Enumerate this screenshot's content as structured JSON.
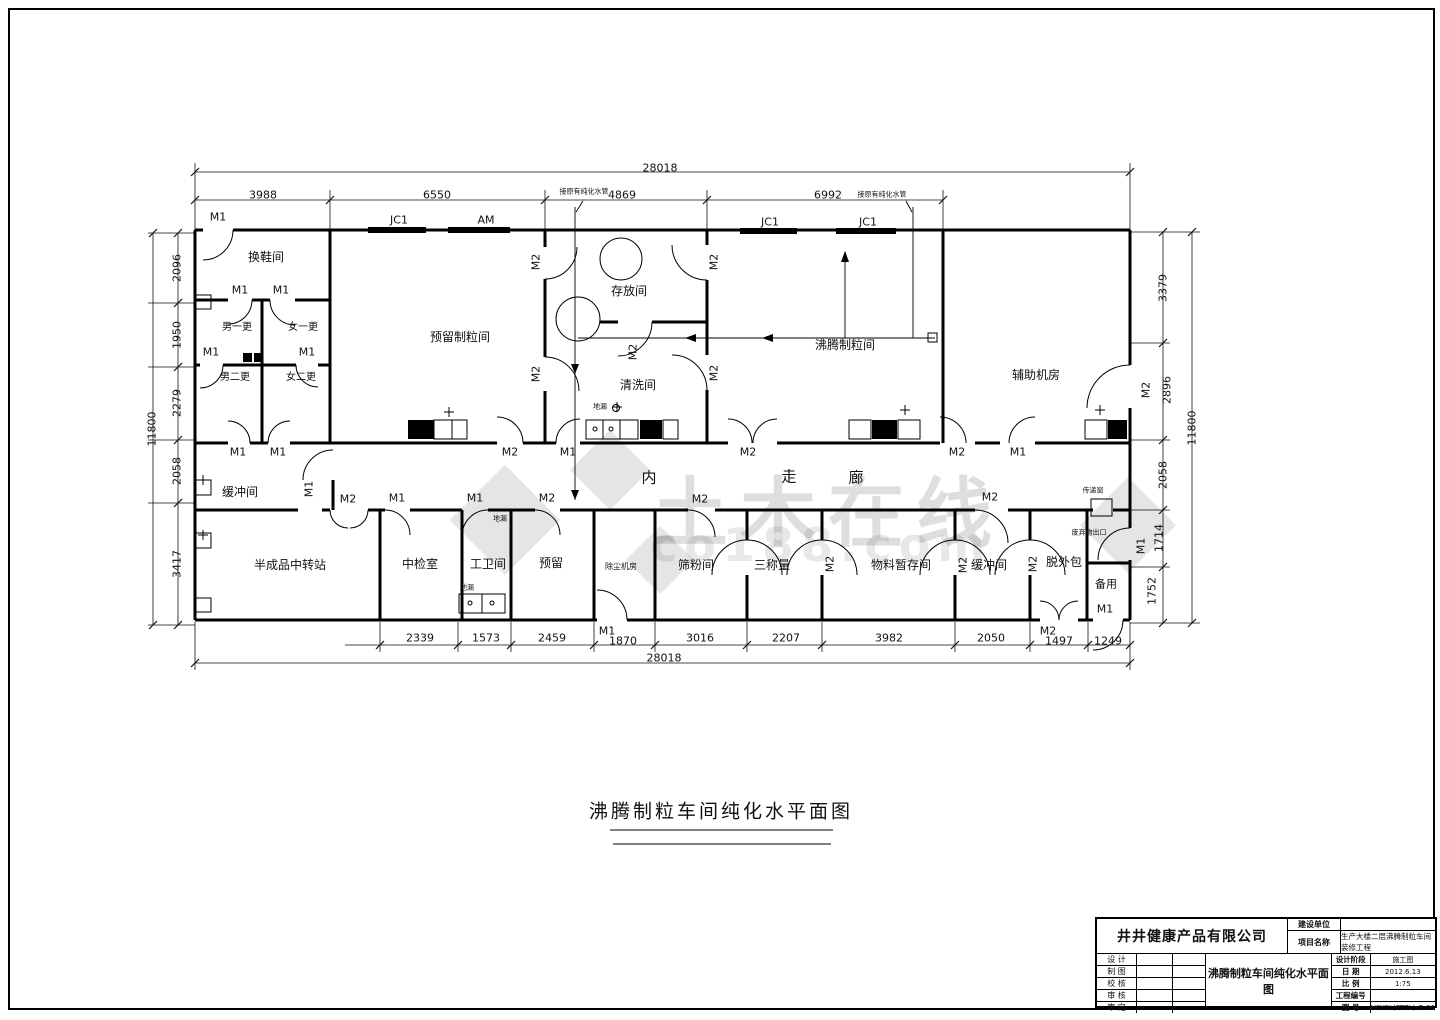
{
  "watermark": {
    "text": "土木在线",
    "sub": "co188.com"
  },
  "title_block": {
    "company": "井井健康产品有限公司",
    "owner_label": "建设单位",
    "owner_value": "",
    "project_label": "项目名称",
    "project_value": "生产大楼二层沸腾制粒车间装修工程",
    "sign_rows": [
      "设 计",
      "制 图",
      "校 核",
      "审 核",
      "审 定"
    ],
    "drawing_title": "沸腾制粒车间纯化水平面图",
    "fields": [
      {
        "label": "设计阶段",
        "value": "施工图"
      },
      {
        "label": "日  期",
        "value": "2012.6.13"
      },
      {
        "label": "比  例",
        "value": "1:75"
      },
      {
        "label": "工程编号",
        "value": ""
      },
      {
        "label": "图  号",
        "value": "HSYSL(FTZL)-G-06"
      }
    ]
  },
  "plan_labels": [
    {
      "t": "28018",
      "x": 660,
      "y": 168,
      "n": "dim-total-top"
    },
    {
      "t": "3988",
      "x": 263,
      "y": 195,
      "n": "dim-label"
    },
    {
      "t": "6550",
      "x": 437,
      "y": 195,
      "n": "dim-label"
    },
    {
      "t": "4869",
      "x": 622,
      "y": 195,
      "n": "dim-label"
    },
    {
      "t": "6992",
      "x": 828,
      "y": 195,
      "n": "dim-label"
    },
    {
      "t": "接原有纯化水管",
      "x": 584,
      "y": 192,
      "s": 7,
      "n": "pipe-annotation"
    },
    {
      "t": "接原有纯化水管",
      "x": 882,
      "y": 195,
      "s": 7,
      "n": "pipe-annotation"
    },
    {
      "t": "M1",
      "x": 218,
      "y": 217,
      "n": "door-label"
    },
    {
      "t": "JC1",
      "x": 399,
      "y": 220,
      "n": "window-label"
    },
    {
      "t": "AM",
      "x": 486,
      "y": 220,
      "n": "window-label"
    },
    {
      "t": "JC1",
      "x": 770,
      "y": 222,
      "n": "window-label"
    },
    {
      "t": "JC1",
      "x": 868,
      "y": 222,
      "n": "window-label"
    },
    {
      "t": "11800",
      "x": 152,
      "y": 429,
      "r": 1,
      "n": "dim-total-left"
    },
    {
      "t": "2096",
      "x": 177,
      "y": 268,
      "r": 1,
      "n": "dim-label"
    },
    {
      "t": "1950",
      "x": 177,
      "y": 335,
      "r": 1,
      "n": "dim-label"
    },
    {
      "t": "2279",
      "x": 177,
      "y": 403,
      "r": 1,
      "n": "dim-label"
    },
    {
      "t": "2058",
      "x": 177,
      "y": 471,
      "r": 1,
      "n": "dim-label"
    },
    {
      "t": "3417",
      "x": 177,
      "y": 564,
      "r": 1,
      "n": "dim-label"
    },
    {
      "t": "3379",
      "x": 1163,
      "y": 288,
      "r": 1,
      "n": "dim-label"
    },
    {
      "t": "M2",
      "x": 1146,
      "y": 390,
      "r": 1,
      "n": "door-label"
    },
    {
      "t": "2896",
      "x": 1167,
      "y": 390,
      "r": 1,
      "n": "dim-label"
    },
    {
      "t": "2058",
      "x": 1163,
      "y": 475,
      "r": 1,
      "n": "dim-label"
    },
    {
      "t": "1714",
      "x": 1159,
      "y": 538,
      "r": 1,
      "n": "dim-label"
    },
    {
      "t": "M1",
      "x": 1141,
      "y": 546,
      "r": 1,
      "n": "door-label"
    },
    {
      "t": "1752",
      "x": 1152,
      "y": 591,
      "r": 1,
      "n": "dim-label"
    },
    {
      "t": "11800",
      "x": 1192,
      "y": 428,
      "r": 1,
      "n": "dim-total-right"
    },
    {
      "t": "2339",
      "x": 420,
      "y": 638,
      "n": "dim-label"
    },
    {
      "t": "1573",
      "x": 486,
      "y": 638,
      "n": "dim-label"
    },
    {
      "t": "2459",
      "x": 552,
      "y": 638,
      "n": "dim-label"
    },
    {
      "t": "M1",
      "x": 607,
      "y": 631,
      "n": "door-label"
    },
    {
      "t": "1870",
      "x": 623,
      "y": 641,
      "n": "dim-label"
    },
    {
      "t": "3016",
      "x": 700,
      "y": 638,
      "n": "dim-label"
    },
    {
      "t": "2207",
      "x": 786,
      "y": 638,
      "n": "dim-label"
    },
    {
      "t": "3982",
      "x": 889,
      "y": 638,
      "n": "dim-label"
    },
    {
      "t": "2050",
      "x": 991,
      "y": 638,
      "n": "dim-label"
    },
    {
      "t": "M2",
      "x": 1048,
      "y": 631,
      "n": "door-label"
    },
    {
      "t": "1497",
      "x": 1059,
      "y": 641,
      "n": "dim-label"
    },
    {
      "t": "1249",
      "x": 1108,
      "y": 641,
      "n": "dim-label"
    },
    {
      "t": "28018",
      "x": 664,
      "y": 658,
      "n": "dim-total-bottom"
    },
    {
      "t": "换鞋间",
      "x": 266,
      "y": 257,
      "s": 12,
      "n": "room-label"
    },
    {
      "t": "男一更",
      "x": 237,
      "y": 328,
      "s": 10,
      "n": "room-label"
    },
    {
      "t": "女一更",
      "x": 303,
      "y": 328,
      "s": 10,
      "n": "room-label"
    },
    {
      "t": "男二更",
      "x": 235,
      "y": 378,
      "s": 10,
      "n": "room-label"
    },
    {
      "t": "女二更",
      "x": 301,
      "y": 378,
      "s": 10,
      "n": "room-label"
    },
    {
      "t": "预留制粒间",
      "x": 460,
      "y": 337,
      "s": 12,
      "n": "room-label"
    },
    {
      "t": "存放间",
      "x": 629,
      "y": 291,
      "s": 12,
      "n": "room-label"
    },
    {
      "t": "清洗间",
      "x": 638,
      "y": 385,
      "s": 12,
      "n": "room-label"
    },
    {
      "t": "沸腾制粒间",
      "x": 845,
      "y": 345,
      "s": 12,
      "n": "room-label"
    },
    {
      "t": "辅助机房",
      "x": 1036,
      "y": 375,
      "s": 12,
      "n": "room-label"
    },
    {
      "t": "缓冲间",
      "x": 240,
      "y": 492,
      "s": 12,
      "n": "room-label"
    },
    {
      "t": "内",
      "x": 649,
      "y": 478,
      "s": 15,
      "n": "corridor-label"
    },
    {
      "t": "走",
      "x": 789,
      "y": 477,
      "s": 15,
      "n": "corridor-label"
    },
    {
      "t": "廊",
      "x": 856,
      "y": 478,
      "s": 15,
      "n": "corridor-label"
    },
    {
      "t": "半成品中转站",
      "x": 290,
      "y": 565,
      "s": 12,
      "n": "room-label"
    },
    {
      "t": "中检室",
      "x": 420,
      "y": 564,
      "s": 12,
      "n": "room-label"
    },
    {
      "t": "工卫间",
      "x": 488,
      "y": 564,
      "s": 12,
      "n": "room-label"
    },
    {
      "t": "预留",
      "x": 551,
      "y": 563,
      "s": 12,
      "n": "room-label"
    },
    {
      "t": "除尘机房",
      "x": 621,
      "y": 567,
      "s": 8,
      "n": "room-label"
    },
    {
      "t": "筛粉间",
      "x": 696,
      "y": 565,
      "s": 12,
      "n": "room-label"
    },
    {
      "t": "三称量",
      "x": 772,
      "y": 565,
      "s": 12,
      "n": "room-label"
    },
    {
      "t": "物料暂存间",
      "x": 901,
      "y": 565,
      "s": 12,
      "n": "room-label"
    },
    {
      "t": "缓冲间",
      "x": 989,
      "y": 565,
      "s": 12,
      "n": "room-label"
    },
    {
      "t": "脱外包",
      "x": 1064,
      "y": 562,
      "s": 12,
      "n": "room-label"
    },
    {
      "t": "备用",
      "x": 1106,
      "y": 584,
      "s": 11,
      "n": "room-label"
    },
    {
      "t": "地漏",
      "x": 600,
      "y": 407,
      "s": 7,
      "n": "floor-drain-label"
    },
    {
      "t": "地漏",
      "x": 500,
      "y": 519,
      "s": 7,
      "n": "floor-drain-label"
    },
    {
      "t": "地漏",
      "x": 467,
      "y": 588,
      "s": 7,
      "n": "floor-drain-label"
    },
    {
      "t": "传递窗",
      "x": 1093,
      "y": 491,
      "s": 7,
      "n": "pass-window-label"
    },
    {
      "t": "废弃物出口",
      "x": 1089,
      "y": 533,
      "s": 7,
      "n": "waste-exit-label"
    },
    {
      "t": "M1",
      "x": 240,
      "y": 290,
      "n": "door-label"
    },
    {
      "t": "M1",
      "x": 281,
      "y": 290,
      "n": "door-label"
    },
    {
      "t": "M1",
      "x": 211,
      "y": 352,
      "n": "door-label"
    },
    {
      "t": "M1",
      "x": 307,
      "y": 352,
      "n": "door-label"
    },
    {
      "t": "M1",
      "x": 238,
      "y": 452,
      "n": "door-label"
    },
    {
      "t": "M1",
      "x": 278,
      "y": 452,
      "n": "door-label"
    },
    {
      "t": "M2",
      "x": 536,
      "y": 262,
      "r": 1,
      "n": "door-label"
    },
    {
      "t": "M2",
      "x": 536,
      "y": 374,
      "r": 1,
      "n": "door-label"
    },
    {
      "t": "M2",
      "x": 714,
      "y": 262,
      "r": 1,
      "n": "door-label"
    },
    {
      "t": "M2",
      "x": 714,
      "y": 373,
      "r": 1,
      "n": "door-label"
    },
    {
      "t": "M2",
      "x": 633,
      "y": 352,
      "r": 1,
      "n": "door-label"
    },
    {
      "t": "M2",
      "x": 510,
      "y": 452,
      "n": "door-label"
    },
    {
      "t": "M1",
      "x": 568,
      "y": 452,
      "n": "door-label"
    },
    {
      "t": "M2",
      "x": 748,
      "y": 452,
      "n": "door-label"
    },
    {
      "t": "M2",
      "x": 957,
      "y": 452,
      "n": "door-label"
    },
    {
      "t": "M1",
      "x": 1018,
      "y": 452,
      "n": "door-label"
    },
    {
      "t": "M1",
      "x": 309,
      "y": 489,
      "r": 1,
      "n": "door-label"
    },
    {
      "t": "M2",
      "x": 348,
      "y": 499,
      "n": "door-label"
    },
    {
      "t": "M1",
      "x": 397,
      "y": 498,
      "n": "door-label"
    },
    {
      "t": "M1",
      "x": 475,
      "y": 498,
      "n": "door-label"
    },
    {
      "t": "M2",
      "x": 547,
      "y": 498,
      "n": "door-label"
    },
    {
      "t": "M2",
      "x": 700,
      "y": 499,
      "n": "door-label"
    },
    {
      "t": "M2",
      "x": 990,
      "y": 497,
      "n": "door-label"
    },
    {
      "t": "M2",
      "x": 830,
      "y": 564,
      "r": 1,
      "n": "door-label"
    },
    {
      "t": "M2",
      "x": 963,
      "y": 565,
      "r": 1,
      "n": "door-label"
    },
    {
      "t": "M2",
      "x": 1033,
      "y": 564,
      "r": 1,
      "n": "door-label"
    },
    {
      "t": "M1",
      "x": 1105,
      "y": 609,
      "n": "door-label"
    },
    {
      "t": "沸腾制粒车间纯化水平面图",
      "x": 721,
      "y": 812,
      "s": 19,
      "cls": "big",
      "n": "drawing-title"
    }
  ]
}
